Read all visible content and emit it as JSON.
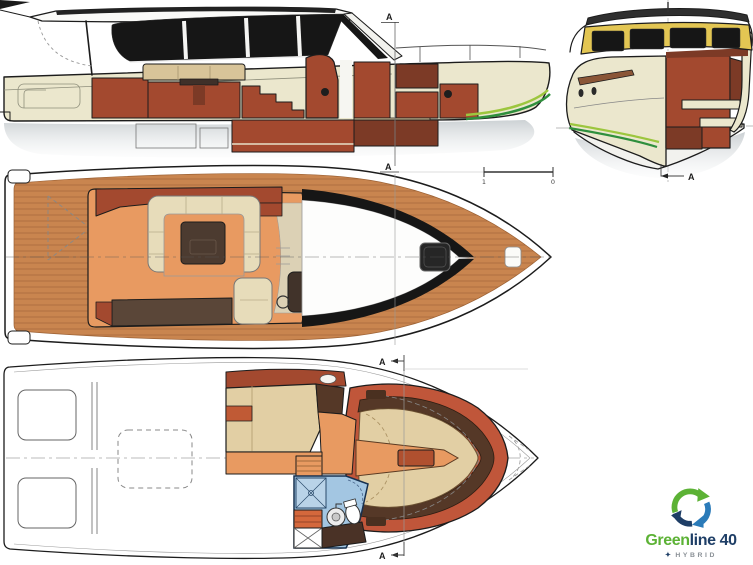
{
  "colors": {
    "outline": "#1c1c1c",
    "hull_cream": "#ebe7cd",
    "glass_black": "#161616",
    "interior_rust": "#a3492f",
    "interior_rust_dark": "#7c3a26",
    "interior_rust_light": "#c0563a",
    "wood_trim_dark": "#553827",
    "sofa_tan": "#d8c499",
    "settee_cream": "#e7dcba",
    "berth_beige": "#e2cfa4",
    "floor_orange": "#e89a61",
    "teak": "#c9854f",
    "teak_line": "#9c6134",
    "table_dark": "#4c3b30",
    "bench_dark": "#5a4638",
    "shadow_gray": "#ccd1d4",
    "stripe_green": "#2f8f3d",
    "stripe_lime": "#9cc63e",
    "frame_yellow": "#e3c653",
    "bath_blue": "#a3c6e2",
    "bath_blue_dark": "#17304f",
    "drawer_orange": "#d4683c",
    "logo_green": "#5cb235",
    "logo_navy": "#1e3e66",
    "logo_blue": "#2b7bb9",
    "tagline_gray": "#8a9096"
  },
  "markers": {
    "side_profile_top": "A",
    "between_views": "A",
    "bow_section": "A",
    "lower_deck_top": "A",
    "lower_deck_bottom": "A"
  },
  "scale_bar": {
    "start_label": "1",
    "end_label": "0"
  },
  "logo": {
    "brand_primary": "Green",
    "brand_secondary": "line 40",
    "tagline": "HYBRID",
    "tagline_mark": "✦"
  }
}
